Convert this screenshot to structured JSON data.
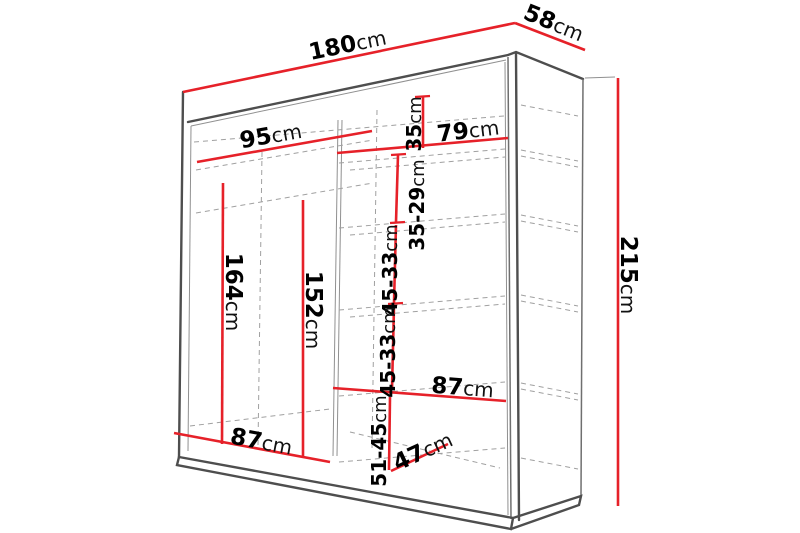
{
  "figure": {
    "type": "furniture-dimension-diagram",
    "subject": "sliding-door wardrobe shown in perspective with interior shelf measurements",
    "background": "#ffffff"
  },
  "colors": {
    "dimension_red": "#e62129",
    "outline_dark": "#4e4e4e",
    "outline_light": "#909090",
    "dashed_gray": "#a0a0a0",
    "text": "#000000"
  },
  "dimensions": {
    "width": {
      "num": "180",
      "unit": "cm"
    },
    "depth": {
      "num": "58",
      "unit": "cm"
    },
    "height": {
      "num": "215",
      "unit": "cm"
    },
    "left_top_width": {
      "num": "95",
      "unit": "cm"
    },
    "right_top_width": {
      "num": "79",
      "unit": "cm"
    },
    "right_gap_top": {
      "num": "35",
      "unit": "cm"
    },
    "right_gap_2": {
      "num": "35-29",
      "unit": "cm"
    },
    "right_gap_3": {
      "num": "45-33",
      "unit": "cm"
    },
    "right_gap_4": {
      "num": "45-33",
      "unit": "cm"
    },
    "left_height": {
      "num": "164",
      "unit": "cm"
    },
    "left_inner_height": {
      "num": "152",
      "unit": "cm"
    },
    "left_bottom_width": {
      "num": "87",
      "unit": "cm"
    },
    "right_bottom_width": {
      "num": "87",
      "unit": "cm"
    },
    "right_bottom_gap": {
      "num": "51-45",
      "unit": "cm"
    },
    "right_bottom_depth": {
      "num": "47",
      "unit": "cm"
    }
  }
}
